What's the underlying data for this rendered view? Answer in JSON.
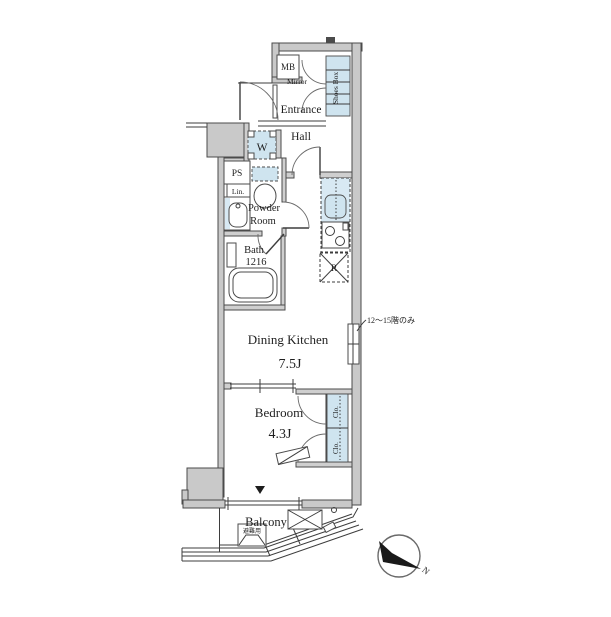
{
  "plan": {
    "labels": {
      "mb": "MB",
      "mirror": "Mirror",
      "entrance": "Entrance",
      "shoes_box": "Shoes Box",
      "hall": "Hall",
      "washer": "W",
      "ps": "PS",
      "lin": "Lin.",
      "powder_line1": "Powder",
      "powder_line2": "Room",
      "bath_line1": "Bath",
      "bath_line2": "1216",
      "fridge": "R",
      "dining_kitchen": "Dining Kitchen",
      "dining_kitchen_size": "7.5J",
      "floor_note": "12〜15階のみ",
      "bedroom": "Bedroom",
      "bedroom_size": "4.3J",
      "closet": "Clo.",
      "balcony": "Balcony",
      "evacuation_hatch": "避難用",
      "north": "N"
    },
    "colors": {
      "wall_fill": "#c9c9c9",
      "fixture_blue": "#cfe4ef",
      "line": "#3d3d3d",
      "background": "#ffffff"
    }
  }
}
